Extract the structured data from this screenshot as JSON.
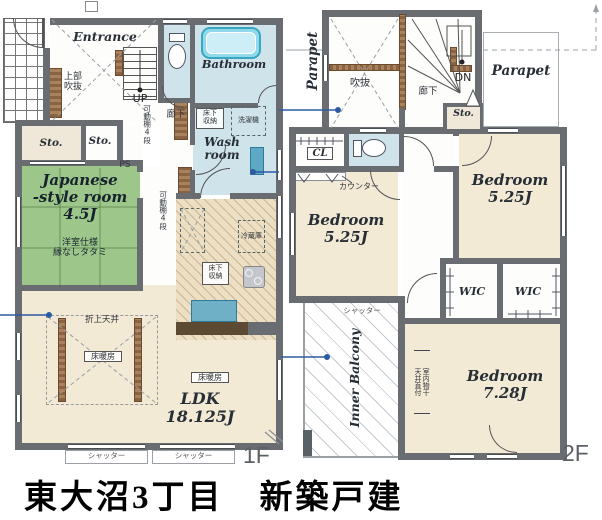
{
  "title": "東大沼3丁目　新築戸建",
  "floor1": {
    "floor_label": "1F",
    "entrance": "Entrance",
    "upper_void": "上部\n吹抜",
    "up": "UP",
    "corridor": "廊下",
    "movable_shelf": "可動棚4段",
    "bathroom": "Bathroom",
    "washroom": "Wash\nroom",
    "underfloor_storage": "床下\n収納",
    "washing_machine": "洗濯機",
    "sto": "Sto.",
    "ps": "PS",
    "japanese_room": "Japanese\n-style room\n4.5J",
    "japanese_room_spec": "洋室仕様\n縁なしタタミ",
    "refrigerator": "冷蔵庫",
    "coved_ceiling": "折上天井",
    "floor_heating": "床暖房",
    "ldk": "LDK\n18.125J",
    "shutter": "シャッター"
  },
  "floor2": {
    "floor_label": "2F",
    "parapet": "Parapet",
    "void": "吹抜",
    "dn": "DN",
    "corridor": "廊下",
    "sto": "Sto.",
    "cl": "CL",
    "counter": "カウンター",
    "bedroom_525": "Bedroom\n5.25J",
    "bedroom_728": "Bedroom\n7.28J",
    "wic": "WIC",
    "shutter": "シャッター",
    "inner_balcony": "Inner Balcony",
    "indoor_drying": "室内物干\n天井直付"
  },
  "colors": {
    "wall": "#696d72",
    "water_blue": "#cfe3ea",
    "floor_cream": "#f3ead6",
    "tatami_green": "#9dc78a",
    "wood_brown": "#8a6342",
    "tub_teal": "#7ed3e6",
    "counter_brown": "#5d4a33",
    "annotation_blue": "#2d5ba3",
    "kitchen_hatch_base": "#ecdfc4"
  }
}
